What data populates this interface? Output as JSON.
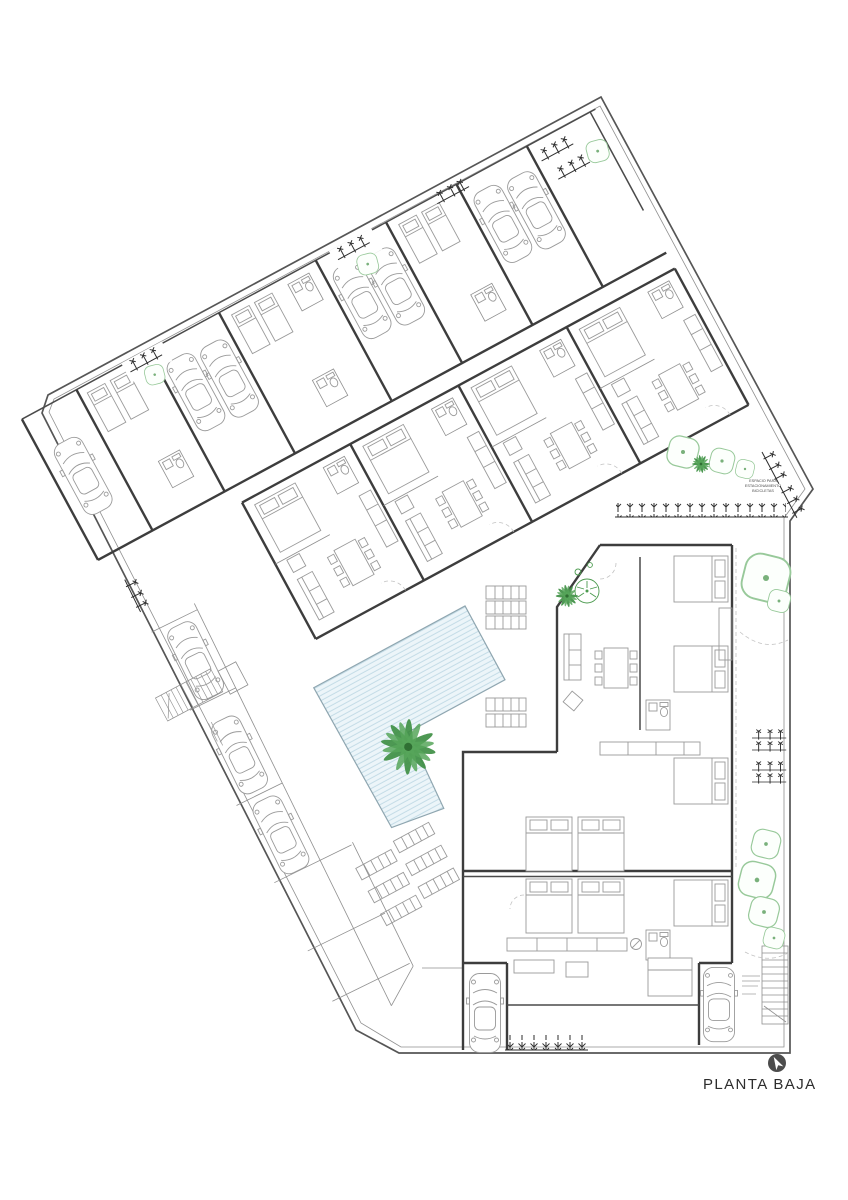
{
  "drawing": {
    "title": {
      "label": "PLANTA BAJA"
    },
    "annotations": {
      "bike_line1": "ESPACIO PARA",
      "bike_line2": "ESTACIONAMIENTO",
      "bike_line3": "BICICLETAS"
    },
    "icons": [
      "north-arrow-icon",
      "palm-tree-icon",
      "tree-icon",
      "car-icon",
      "staircase-icon",
      "pool",
      "sun-lounger-icon",
      "hedge-ticks-icon"
    ],
    "colors": {
      "paper": "#ffffff",
      "wall_line": "#3d3d3d",
      "light_line": "#9a9a9a",
      "pool_fill": "#ecf5f9",
      "pool_stripe": "#bfd9e4",
      "green_dark": "#3f8f44",
      "green_light": "#98c99a",
      "north_badge": "#4c4c4c"
    }
  }
}
